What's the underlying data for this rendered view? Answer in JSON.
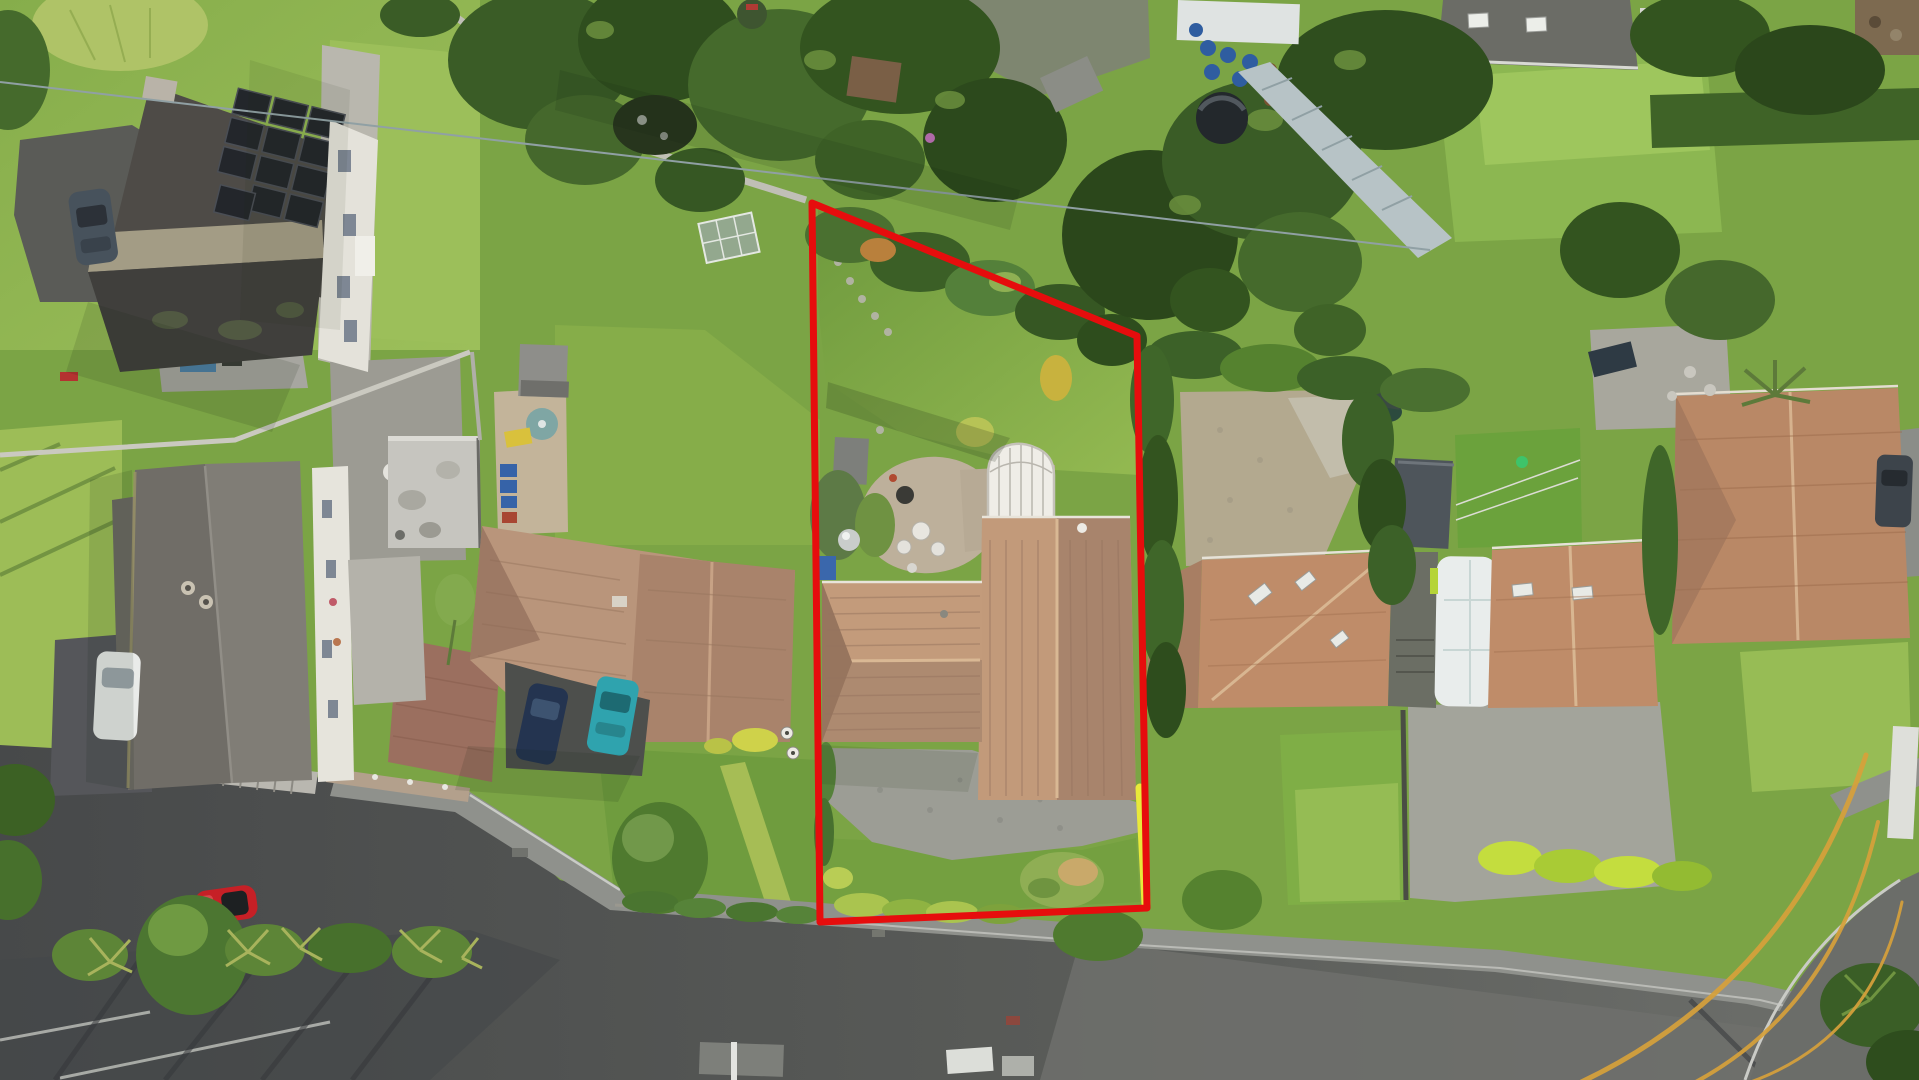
{
  "meta": {
    "type": "aerial-drone-photograph",
    "subject": "suburban residential street with property boundary overlay",
    "width": 1919,
    "height": 1080
  },
  "boundary": {
    "label": "subject property boundary",
    "color": "#e60d0d",
    "stroke_width": 7,
    "points": "812,203 1137,336 1147,908 820,922",
    "highlight": {
      "label": "yellow highlighted segment near road frontage",
      "color": "#e9e93a",
      "stroke_width": 9,
      "points": "1140,788 1146,904"
    }
  },
  "watermark": {
    "label": "gold agency watermark arcs",
    "color": "#d7a13b",
    "arcs": [
      "M1575,1085 Q1790,985 1866,755",
      "M1690,1085 Q1835,1010 1878,822",
      "M1742,1085 Q1872,1042 1902,902"
    ]
  },
  "palette": {
    "grass_base": "#7ba445",
    "grass_light": "#9cbe58",
    "grass_dark": "#567d31",
    "tree_dark": "#2f4f1f",
    "tree_mid": "#45682c",
    "hedge_lime": "#c4dd3e",
    "roof_terracotta": "#bb9072",
    "roof_terracotta_light": "#c8a384",
    "roof_terracotta_dark": "#9c7860",
    "roof_slate": "#4e4b47",
    "roof_grey": "#77746e",
    "solar_panel": "#23262b",
    "road": "#525451",
    "pavement": "#8f918c",
    "gravel": "#9c9d95",
    "patio_beige": "#bdb09b",
    "cobble": "#b3a98f",
    "white_structure": "#e9ebe9",
    "car_red": "#c62026",
    "car_teal": "#2fa3ae",
    "car_navy": "#243450"
  },
  "scene": {
    "features": [
      {
        "name": "subject-property",
        "description": "centre plot outlined in red: long rear lawn, shrub border, beige patio, white arched conservatory, T-shaped terracotta-roof bungalow, gravel driveway, front hedge"
      },
      {
        "name": "neighbour-house-west",
        "description": "terracotta L-shaped roof, flat garage roof, navy and teal cars on drive, front lawn with young tree"
      },
      {
        "name": "neighbour-house-far-west",
        "description": "long grey roof house with white car on dark driveway"
      },
      {
        "name": "corner-house-north-west",
        "description": "dark slate roof with solar panel array, dark estate car"
      },
      {
        "name": "neighbour-houses-east",
        "description": "pair of terracotta roofs with skylights, white caravan parked between, cobbled court and dark shed behind"
      },
      {
        "name": "far-east-house",
        "description": "large terracotta hipped roof with dark car on drive"
      },
      {
        "name": "road",
        "description": "asphalt road running along the bottom with pavement, kerb lines, pole shadows, red sports car parked on verge side"
      },
      {
        "name": "gardens",
        "description": "dense mature trees along the top, greenhouse walkway, blue barrels, round dark pool, sheds, lawns and hedges"
      }
    ]
  }
}
